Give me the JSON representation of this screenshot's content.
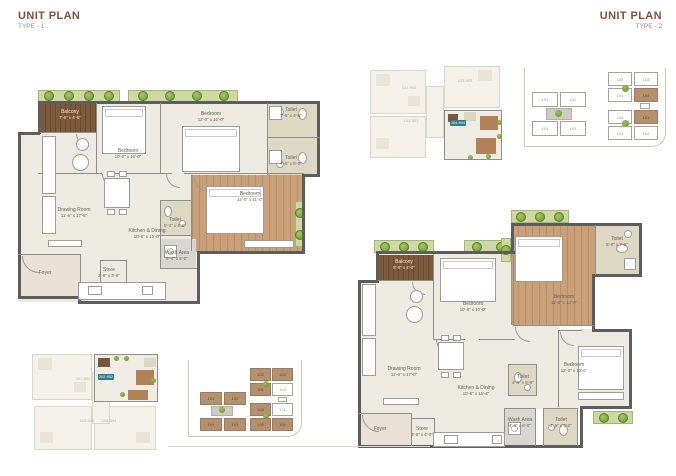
{
  "colors": {
    "title_brown": "#7c5340",
    "wall_gray": "#5d5d5d",
    "wood_floor": "#c9a078",
    "deck_wood": "#7d5a3c",
    "planter_green": "#cdd9a0",
    "toilet_khaki": "#ddd8c2",
    "highlight_teal": "#2d7e8c",
    "site_unit_brown": "#b5906e"
  },
  "plan1": {
    "title": "UNIT PLAN",
    "subtitle": "TYPE - 1",
    "rooms": {
      "balcony": {
        "name": "Balcony",
        "dim": "7'-6\" x 4'-6\""
      },
      "bedroom1": {
        "name": "Bedroom",
        "dim": "10'-0\" x 10'-0\""
      },
      "bedroom2": {
        "name": "Bedroom",
        "dim": "12'-0\" x 10'-0\""
      },
      "toilet1": {
        "name": "Toilet",
        "dim": "7'-6\" x 4'-6\""
      },
      "toilet2": {
        "name": "Toilet",
        "dim": "7'-6\" x 5'-0\""
      },
      "master": {
        "name": "Bedroom",
        "dim": "14'-0\" x 11'-0\""
      },
      "drawing": {
        "name": "Drawing Room",
        "dim": "11'-6\" x 17'-6\""
      },
      "kitchen": {
        "name": "Kitchen & Dining",
        "dim": "10'-6\" x 15'-0\""
      },
      "toilet3": {
        "name": "Toilet",
        "dim": "5'-2\" x 4'-6\""
      },
      "wash": {
        "name": "Wash Area",
        "dim": "5'-4\" x 5'-0\""
      },
      "foyer": {
        "name": "Foyer"
      },
      "store": {
        "name": "Store",
        "dim": "2'-6\" x 3'-6\""
      }
    },
    "keyplan": {
      "label_faded1": "201-901",
      "label_highlight": "202-902",
      "label_faded2": "203-903",
      "label_faded3": "204-904"
    }
  },
  "plan2": {
    "title": "UNIT PLAN",
    "subtitle": "TYPE - 2",
    "rooms": {
      "balcony": {
        "name": "Balcony",
        "dim": "8'-0\" x 4'-0\""
      },
      "bedroom1": {
        "name": "Bedroom",
        "dim": "10'-0\" x 10'-0\""
      },
      "master": {
        "name": "Bedroom",
        "dim": "11'-0\" x 14'-0\""
      },
      "toilet1": {
        "name": "Toilet",
        "dim": "5'-0\" x 7'-6\""
      },
      "bedroom3": {
        "name": "Bedroom",
        "dim": "12'-0\" x 10'-6\""
      },
      "drawing": {
        "name": "Drawing Room",
        "dim": "11'-6\" x 17'-0\""
      },
      "kitchen": {
        "name": "Kitchen & Dining",
        "dim": "10'-6\" x 15'-4\""
      },
      "toilet2": {
        "name": "Toilet",
        "dim": "4'-6\" x 5'-6\""
      },
      "wash": {
        "name": "Wash Area",
        "dim": "4'-6\" x 6'-0\""
      },
      "toilet3": {
        "name": "Toilet",
        "dim": "4'-6\" x 5'-0\""
      },
      "foyer": {
        "name": "Foyer"
      },
      "store": {
        "name": "Store",
        "dim": "3'-6\" x 4'-0\""
      }
    },
    "keyplan": {
      "label_faded1": "102-902",
      "label_faded2": "103-903",
      "label_faded3": "101-901",
      "label_highlight": "104-904"
    }
  },
  "siteplan": {
    "left": [
      "101",
      "102",
      "104",
      "103"
    ],
    "right_top": [
      "102",
      "103",
      "101",
      "104"
    ],
    "right_bottom": [
      "104",
      "101",
      "103",
      "102"
    ]
  }
}
